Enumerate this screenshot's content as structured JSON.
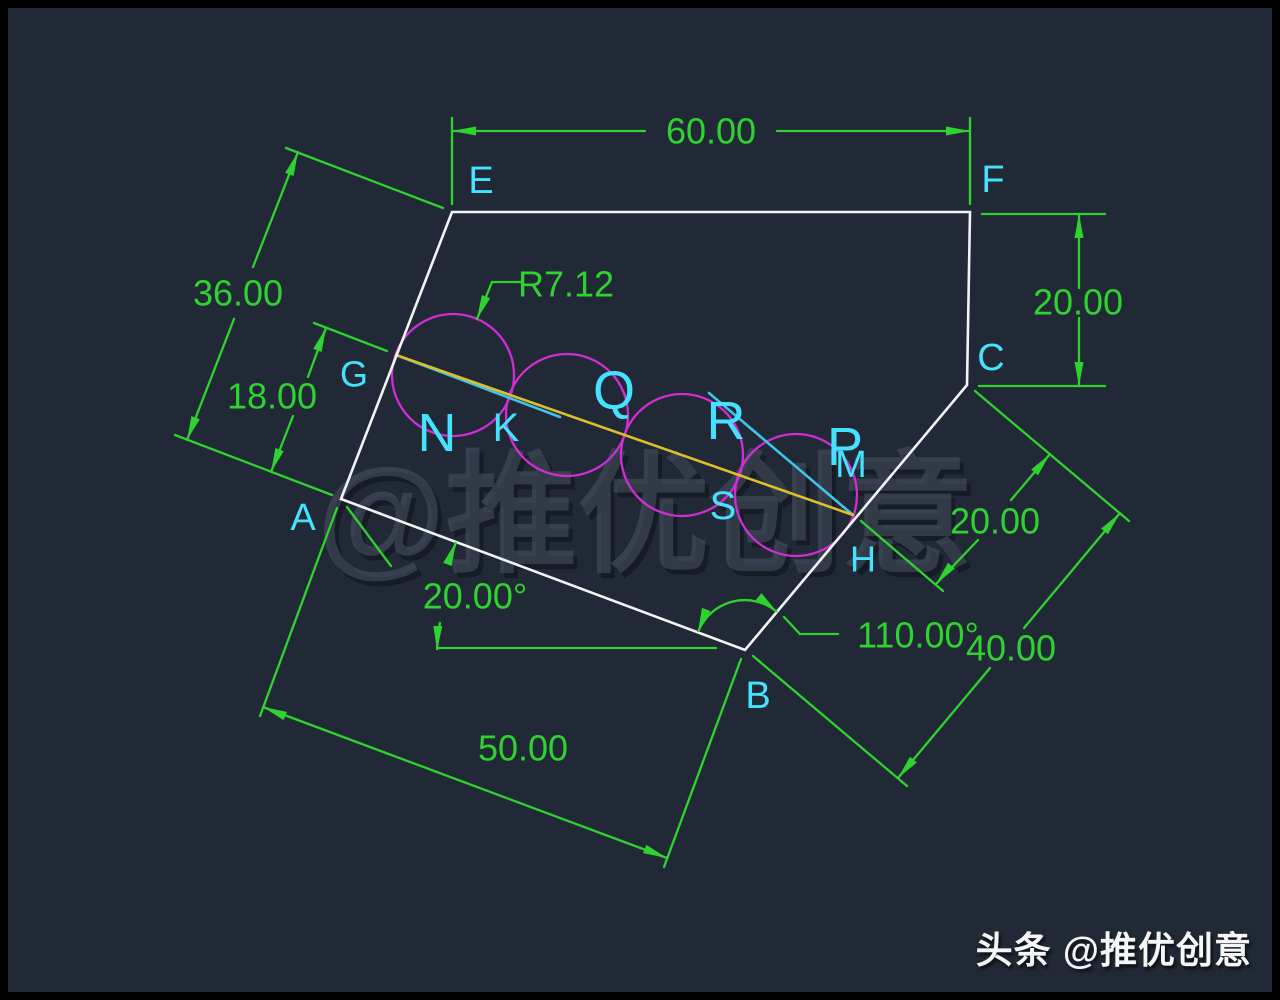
{
  "title": "CAD practice drawing - pentagon EFCBA with four tangent circles",
  "watermarks": {
    "center": {
      "text": "@推优创意",
      "x": 645,
      "y": 515,
      "size": 132
    },
    "corner": {
      "text": "头条 @推优创意"
    }
  },
  "drawing": {
    "frame_color": "#000000",
    "bg_color": "#212936",
    "colors": {
      "edge": "#f2f3f5",
      "dim": "#2fd32f",
      "label": "#45e2ff",
      "circle": "#cf2ed2",
      "line_yellow": "#ddbe2e",
      "line_cyan": "#3fc3e8",
      "wm_main": "#4a5464",
      "wm_shadow": "#0c1016"
    },
    "polygon": {
      "points": [
        [
          452,
          212
        ],
        [
          970,
          212
        ],
        [
          967,
          385
        ],
        [
          745,
          650
        ],
        [
          341,
          499
        ]
      ]
    },
    "circles": {
      "r": 61,
      "centers": [
        [
          453,
          375
        ],
        [
          567,
          415
        ],
        [
          682,
          455
        ],
        [
          796,
          495
        ]
      ]
    },
    "lines": [
      {
        "x1": 396,
        "y1": 355,
        "x2": 560,
        "y2": 417,
        "c": "line_cyan",
        "name": "construction-line-cyan-left"
      },
      {
        "x1": 709,
        "y1": 393,
        "x2": 853,
        "y2": 515,
        "c": "line_cyan",
        "name": "construction-line-cyan-right"
      },
      {
        "x1": 396,
        "y1": 355,
        "x2": 853,
        "y2": 515,
        "c": "line_yellow",
        "name": "construction-line-yellow-GH"
      }
    ],
    "dim_segments": [
      [
        452,
        118,
        452,
        204
      ],
      [
        970,
        118,
        970,
        204
      ],
      [
        452,
        131,
        645,
        131
      ],
      [
        777,
        131,
        970,
        131
      ],
      [
        443,
        208,
        286,
        148
      ],
      [
        332,
        495,
        175,
        435
      ],
      [
        187,
        440,
        234,
        319
      ],
      [
        253,
        267,
        298,
        152
      ],
      [
        387,
        351,
        314,
        323
      ],
      [
        271,
        472,
        293,
        416
      ],
      [
        308,
        377,
        326,
        328
      ],
      [
        337,
        508,
        260,
        716
      ],
      [
        741,
        659,
        664,
        867
      ],
      [
        263,
        707,
        667,
        858
      ],
      [
        347,
        507,
        391,
        566
      ],
      [
        982,
        214,
        1105,
        214
      ],
      [
        979,
        386,
        1105,
        386
      ],
      [
        1079,
        214,
        1079,
        288
      ],
      [
        1079,
        318,
        1079,
        386
      ],
      [
        975,
        391,
        1129,
        521
      ],
      [
        861,
        521,
        943,
        591
      ],
      [
        1050,
        454,
        1011,
        500
      ],
      [
        978,
        540,
        936,
        584
      ],
      [
        753,
        656,
        907,
        786
      ],
      [
        1120,
        513,
        1024,
        628
      ],
      [
        990,
        668,
        898,
        778
      ],
      [
        437,
        648,
        716,
        648
      ],
      [
        784,
        617,
        800,
        634
      ],
      [
        800,
        634,
        838,
        634
      ],
      [
        477,
        319,
        492,
        282
      ],
      [
        492,
        282,
        522,
        282
      ]
    ],
    "dim_arcs": [
      {
        "d": "M 698 632 A 50 50 0 0 1 777 612"
      },
      {
        "d": "M 437 650 A 308 308 0 0 1 440 622"
      },
      {
        "d": "M 449 564 A 308 308 0 0 1 456 542"
      }
    ],
    "arrows": [
      [
        452,
        131,
        180
      ],
      [
        970,
        131,
        0
      ],
      [
        187,
        440,
        111
      ],
      [
        298,
        152,
        -69
      ],
      [
        271,
        472,
        111
      ],
      [
        326,
        328,
        -69
      ],
      [
        263,
        707,
        -158
      ],
      [
        667,
        858,
        22
      ],
      [
        1079,
        214,
        -90
      ],
      [
        1079,
        386,
        90
      ],
      [
        1050,
        454,
        -50
      ],
      [
        936,
        584,
        130
      ],
      [
        1120,
        513,
        -50
      ],
      [
        898,
        778,
        130
      ],
      [
        698,
        632,
        110
      ],
      [
        777,
        612,
        40
      ],
      [
        437,
        650,
        92
      ],
      [
        456,
        542,
        -69
      ],
      [
        477,
        319,
        112
      ]
    ],
    "dim_texts": [
      {
        "t": "60.00",
        "x": 711,
        "y": 131,
        "s": 36
      },
      {
        "t": "36.00",
        "x": 238,
        "y": 293,
        "s": 36
      },
      {
        "t": "18.00",
        "x": 272,
        "y": 396,
        "s": 36
      },
      {
        "t": "50.00",
        "x": 523,
        "y": 748,
        "s": 36
      },
      {
        "t": "20.00",
        "x": 1078,
        "y": 302,
        "s": 36
      },
      {
        "t": "20.00",
        "x": 995,
        "y": 521,
        "s": 36
      },
      {
        "t": "40.00",
        "x": 1011,
        "y": 648,
        "s": 36
      },
      {
        "t": "20.00°",
        "x": 475,
        "y": 596,
        "s": 36
      },
      {
        "t": "110.00°",
        "x": 918,
        "y": 635,
        "s": 36
      },
      {
        "t": "R7.12",
        "x": 566,
        "y": 284,
        "s": 36
      }
    ],
    "labels": [
      {
        "t": "E",
        "x": 481,
        "y": 181,
        "s": 38
      },
      {
        "t": "F",
        "x": 993,
        "y": 180,
        "s": 38
      },
      {
        "t": "C",
        "x": 991,
        "y": 358,
        "s": 38
      },
      {
        "t": "B",
        "x": 758,
        "y": 696,
        "s": 38
      },
      {
        "t": "A",
        "x": 303,
        "y": 518,
        "s": 38
      },
      {
        "t": "G",
        "x": 354,
        "y": 374,
        "s": 36
      },
      {
        "t": "H",
        "x": 863,
        "y": 559,
        "s": 36
      },
      {
        "t": "N",
        "x": 437,
        "y": 433,
        "s": 54
      },
      {
        "t": "K",
        "x": 506,
        "y": 428,
        "s": 40
      },
      {
        "t": "Q",
        "x": 614,
        "y": 391,
        "s": 54
      },
      {
        "t": "R",
        "x": 726,
        "y": 421,
        "s": 54
      },
      {
        "t": "P",
        "x": 845,
        "y": 447,
        "s": 54
      },
      {
        "t": "S",
        "x": 723,
        "y": 506,
        "s": 40
      },
      {
        "t": "M",
        "x": 851,
        "y": 465,
        "s": 38
      }
    ]
  }
}
